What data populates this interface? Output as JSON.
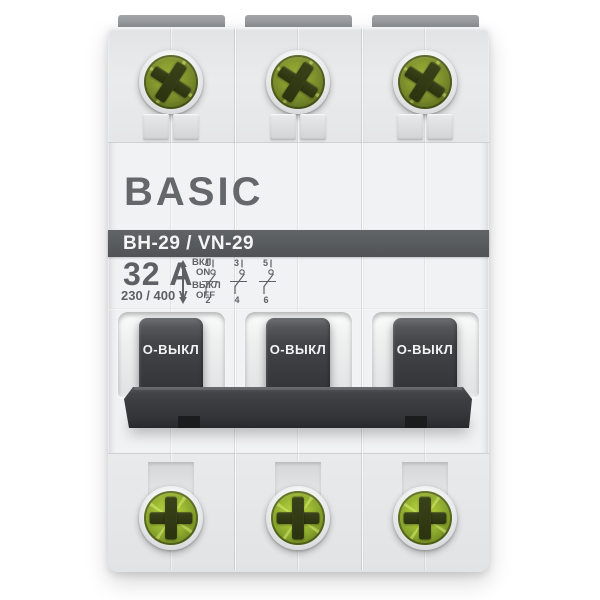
{
  "product": {
    "brand": "BASIC",
    "model": "ВН-29 / VN-29",
    "current": "32 A",
    "voltage": "230 / 400 V"
  },
  "legend": {
    "on_ru": "ВКЛ",
    "on_en": "ON",
    "off_ru": "ВЫКЛ",
    "off_en": "OFF"
  },
  "diagram": {
    "top_terminals": [
      "1",
      "3",
      "5"
    ],
    "bottom_terminals": [
      "2",
      "4",
      "6"
    ]
  },
  "toggles": [
    {
      "label": "О-ВЫКЛ"
    },
    {
      "label": "О-ВЫКЛ"
    },
    {
      "label": "О-ВЫКЛ"
    }
  ],
  "colors": {
    "band_background": "#595c5f",
    "marking_gray": "#5d6165",
    "toggle_dark": "#3a3c3f",
    "screw_green_top": "#7f9328",
    "screw_green_bottom": "#9ab82f",
    "body_light": "#f1f2f3"
  }
}
